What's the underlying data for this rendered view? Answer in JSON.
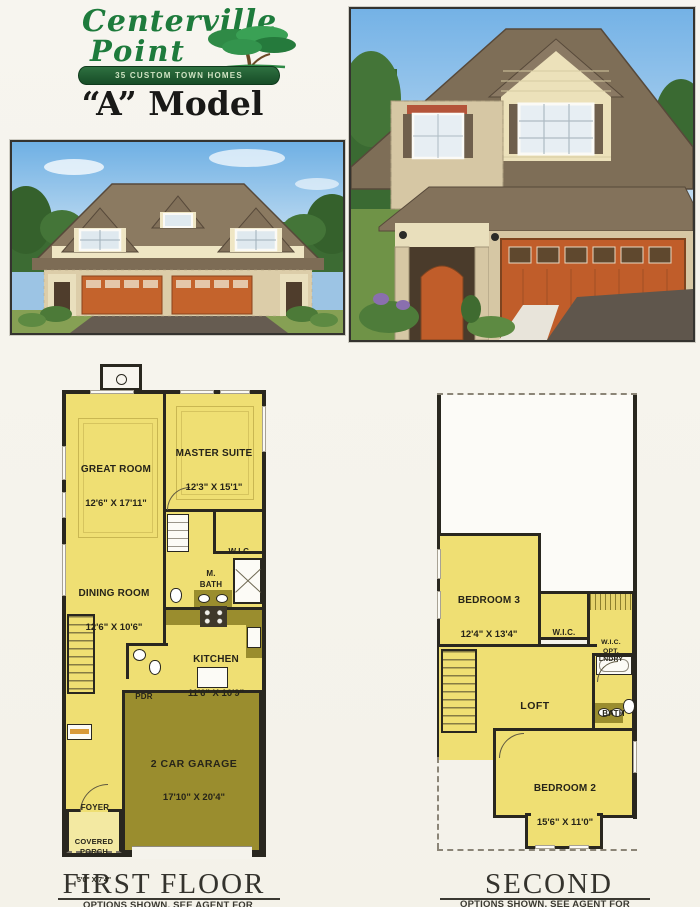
{
  "logo": {
    "line1": "Centerville",
    "line2": "Point",
    "banner": "35 CUSTOM TOWN HOMES",
    "brand_green": "#1e7b3c"
  },
  "title": "“A” Model",
  "first_floor": {
    "caption": "FIRST FLOOR",
    "note": "OPTIONS SHOWN, SEE AGENT FOR DETAILS",
    "rooms": {
      "great_room": {
        "name": "GREAT ROOM",
        "dims": "12'6\" X 17'11\""
      },
      "master_suite": {
        "name": "MASTER SUITE",
        "dims": "12'3\" X 15'1\""
      },
      "wic": {
        "name": "W.I.C."
      },
      "m_bath": {
        "name": "M.\nBATH"
      },
      "dining_room": {
        "name": "DINING ROOM",
        "dims": "12'6\" X 10'6\""
      },
      "kitchen": {
        "name": "KITCHEN",
        "dims": "11'6\" X 10'9\""
      },
      "pdr": {
        "name": "PDR"
      },
      "garage": {
        "name": "2 CAR GARAGE",
        "dims": "17'10\" X 20'4\""
      },
      "foyer": {
        "name": "FOYER"
      },
      "covered_porch": {
        "name": "COVERED\nPORCH",
        "dims": "5'0\" X 7'4\""
      }
    }
  },
  "second_floor": {
    "caption": "SECOND FLOOR",
    "note": "OPTIONS SHOWN, SEE AGENT FOR DETAILS",
    "rooms": {
      "bedroom3": {
        "name": "BEDROOM 3",
        "dims": "12'4\" X 13'4\""
      },
      "wic": {
        "name": "W.I.C."
      },
      "wic_opt": {
        "name": "W.I.C.\nOPT.\nLNDRY"
      },
      "loft": {
        "name": "LOFT"
      },
      "bath": {
        "name": "BATH"
      },
      "bedroom2": {
        "name": "BEDROOM 2",
        "dims": "15'6\" X 11'0\""
      }
    }
  },
  "colors": {
    "plan_yellow": "#efdf73",
    "plan_olive": "#9a8d2e",
    "wall": "#29271f",
    "porch_yellow": "#f3e9a2"
  }
}
